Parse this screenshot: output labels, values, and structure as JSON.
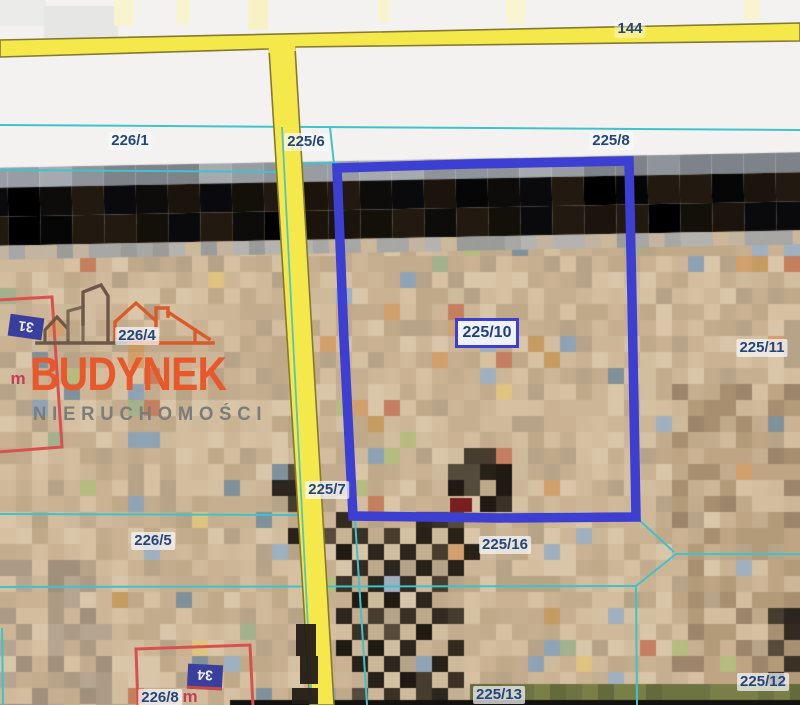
{
  "map": {
    "road_label": "144",
    "parcel_labels": [
      {
        "text": "226/1",
        "x": 130,
        "y": 141
      },
      {
        "text": "225/6",
        "x": 306,
        "y": 142
      },
      {
        "text": "225/8",
        "x": 611,
        "y": 141
      },
      {
        "text": "226/4",
        "x": 137,
        "y": 336
      },
      {
        "text": "225/11",
        "x": 762,
        "y": 348
      },
      {
        "text": "225/7",
        "x": 327,
        "y": 490
      },
      {
        "text": "226/5",
        "x": 153,
        "y": 541
      },
      {
        "text": "225/16",
        "x": 505,
        "y": 545
      },
      {
        "text": "226/8",
        "x": 160,
        "y": 698
      },
      {
        "text": "225/13",
        "x": 499,
        "y": 695
      },
      {
        "text": "225/12",
        "x": 763,
        "y": 682
      }
    ],
    "selected_parcel": {
      "label": "225/10",
      "x": 487,
      "y": 333
    },
    "building_numbers": [
      {
        "text": "31",
        "x": 26,
        "y": 327,
        "cls": "b31"
      },
      {
        "text": "34",
        "x": 205,
        "y": 677,
        "cls": "b34"
      }
    ],
    "building_marks": [
      {
        "text": "m",
        "x": 18,
        "y": 379
      },
      {
        "text": "m",
        "x": 190,
        "y": 697
      }
    ]
  },
  "watermark": {
    "brand": "BUDYNEK",
    "subtitle": "NIERUCHOMOŚCI"
  },
  "colors": {
    "selection": "#3d3ed2",
    "cyan": "#3fc3cb",
    "road_fill": "#f4e84a",
    "road_stroke": "#857931",
    "label_text": "#24457c",
    "red_building": "#d95050",
    "brand_orange": "#e8582b",
    "subtitle_gray": "#7c7c7a",
    "navy_box": "#3a3e9c",
    "white_area": "#f3f2f0"
  },
  "geometry": {
    "selection_path": "M337,168 L470,164 L629,161 L632,300 L636,517 L500,518 L353,516 L344,340 Z",
    "roads": {
      "horizontal": "0,40 800,23 800,41 296,47 268,49 0,57",
      "vertical": "269,49 295,47 334,705 310,705",
      "junction": "270,41 294,39 296,51 268,53"
    },
    "cyan_under": [
      [
        0,
        125,
        800,
        130
      ],
      [
        0,
        170,
        284,
        172
      ],
      [
        298,
        164,
        338,
        163
      ],
      [
        330,
        127,
        334,
        164
      ],
      [
        0,
        514,
        306,
        515
      ],
      [
        355,
        519,
        367,
        705
      ],
      [
        0,
        587,
        636,
        586
      ],
      [
        636,
        586,
        637,
        705
      ],
      [
        636,
        586,
        676,
        554
      ],
      [
        676,
        554,
        800,
        554
      ],
      [
        638,
        519,
        674,
        552
      ],
      [
        2,
        628,
        3,
        705
      ]
    ],
    "cyan_over": [
      [
        282,
        127,
        312,
        705
      ]
    ],
    "red_buildings": [
      "M-2,300 L52,297 L62,447 L-2,452",
      "M136,649 L250,645 L253,707 L138,707 Z"
    ],
    "road_shadow_blocks": [
      [
        296,
        624,
        20,
        32
      ],
      [
        300,
        656,
        18,
        28
      ],
      [
        292,
        688,
        26,
        16
      ]
    ]
  },
  "photo": {
    "cell": 16,
    "base_palette": [
      "#cdb697",
      "#c6ae90",
      "#d3bd9f",
      "#c0a989",
      "#d9c5a8",
      "#cab293",
      "#b7a488",
      "#cfb99b",
      "#c3ab8d",
      "#d6c0a2"
    ],
    "accent_palette": [
      "#c79b62",
      "#a3b18c",
      "#9fb0bf",
      "#7f929b",
      "#c47f5e",
      "#b6bb80",
      "#8fa3b5",
      "#d2a06c",
      "#e0c37f"
    ],
    "accent_chance": 0.07,
    "dark_palette": [
      "#3a3127",
      "#2c2620",
      "#1f1a14",
      "#463c2f",
      "#554b3c",
      "#27211a",
      "#332b21"
    ],
    "tint_zones": [
      {
        "x0": 672,
        "y0": 376,
        "x1": 800,
        "y1": 700,
        "chance": 0.5,
        "palette": [
          "#b39a79",
          "#a78f70",
          "#9c856a",
          "#c0a585"
        ]
      },
      {
        "x0": 0,
        "y0": 560,
        "x1": 112,
        "y1": 705,
        "chance": 0.55,
        "palette": [
          "#ac9a85",
          "#a1907c",
          "#b6a591"
        ]
      }
    ],
    "tree_blocks": [
      [
        448,
        464
      ],
      [
        464,
        464
      ],
      [
        480,
        464
      ],
      [
        496,
        464
      ],
      [
        448,
        480
      ],
      [
        464,
        480
      ],
      [
        496,
        480
      ],
      [
        480,
        496
      ],
      [
        496,
        496
      ],
      [
        464,
        448
      ],
      [
        480,
        448
      ],
      [
        336,
        512
      ],
      [
        416,
        512
      ],
      [
        432,
        512
      ],
      [
        448,
        512
      ],
      [
        320,
        528
      ],
      [
        352,
        528
      ],
      [
        384,
        528
      ],
      [
        416,
        528
      ],
      [
        448,
        528
      ],
      [
        336,
        544
      ],
      [
        368,
        544
      ],
      [
        400,
        544
      ],
      [
        432,
        544
      ],
      [
        464,
        544
      ],
      [
        352,
        560
      ],
      [
        384,
        560
      ],
      [
        416,
        560
      ],
      [
        448,
        560
      ],
      [
        336,
        576
      ],
      [
        368,
        576
      ],
      [
        400,
        576
      ],
      [
        432,
        576
      ],
      [
        352,
        592
      ],
      [
        384,
        592
      ],
      [
        416,
        592
      ],
      [
        336,
        608
      ],
      [
        368,
        608
      ],
      [
        400,
        608
      ],
      [
        432,
        608
      ],
      [
        448,
        608
      ],
      [
        352,
        624
      ],
      [
        384,
        624
      ],
      [
        416,
        624
      ],
      [
        336,
        640
      ],
      [
        368,
        640
      ],
      [
        400,
        640
      ],
      [
        448,
        640
      ],
      [
        352,
        656
      ],
      [
        384,
        656
      ],
      [
        432,
        656
      ],
      [
        368,
        672
      ],
      [
        400,
        672
      ],
      [
        416,
        672
      ],
      [
        448,
        672
      ],
      [
        352,
        688
      ],
      [
        384,
        688
      ],
      [
        416,
        688
      ],
      [
        432,
        688
      ],
      [
        288,
        464
      ],
      [
        288,
        480
      ],
      [
        272,
        480
      ],
      [
        288,
        496
      ],
      [
        304,
        512
      ],
      [
        288,
        528
      ],
      [
        768,
        608
      ],
      [
        784,
        624
      ],
      [
        768,
        640
      ],
      [
        784,
        656
      ],
      [
        768,
        672
      ],
      [
        784,
        608
      ]
    ],
    "red_block": [
      450,
      498,
      22,
      14
    ],
    "olive_band": {
      "x": 470,
      "y": 684,
      "w": 330,
      "h": 16,
      "colors": [
        "#6e7342",
        "#7a7f48",
        "#646a3c"
      ]
    },
    "bottom_strip": {
      "x": 230,
      "y": 700,
      "w": 570,
      "h": 5,
      "color": "#14120e"
    },
    "top_patches": [
      [
        0,
        0,
        46,
        26,
        "#ebebe9"
      ],
      [
        44,
        6,
        74,
        34,
        "#e6e6e4"
      ],
      [
        114,
        0,
        20,
        26,
        "#f8f4cf"
      ],
      [
        176,
        0,
        14,
        24,
        "#f8f4cf"
      ],
      [
        248,
        0,
        20,
        30,
        "#f7f2c6"
      ],
      [
        378,
        0,
        12,
        22,
        "#f8f4cf"
      ],
      [
        506,
        0,
        20,
        24,
        "#f9f5d2"
      ],
      [
        744,
        0,
        16,
        20,
        "#f8f4cf"
      ]
    ],
    "bands": {
      "angle": -1.1,
      "cy": 199,
      "gray": {
        "y": 160,
        "h": 20,
        "colors": [
          "#8f939a",
          "#a6aaaf",
          "#7e8289",
          "#999da3"
        ]
      },
      "black": {
        "y": 180,
        "h": 58,
        "colors": [
          "#060606",
          "#0d0c0a",
          "#13100a",
          "#1b140c",
          "#000000",
          "#221910",
          "#0a0a0c"
        ]
      },
      "gray_row": {
        "y": 238,
        "h": 14,
        "colors": [
          "#a7a7a5",
          "#b5b3b0",
          "#9b9c9a",
          "#c2b49e",
          "#cbb79a"
        ]
      }
    }
  }
}
